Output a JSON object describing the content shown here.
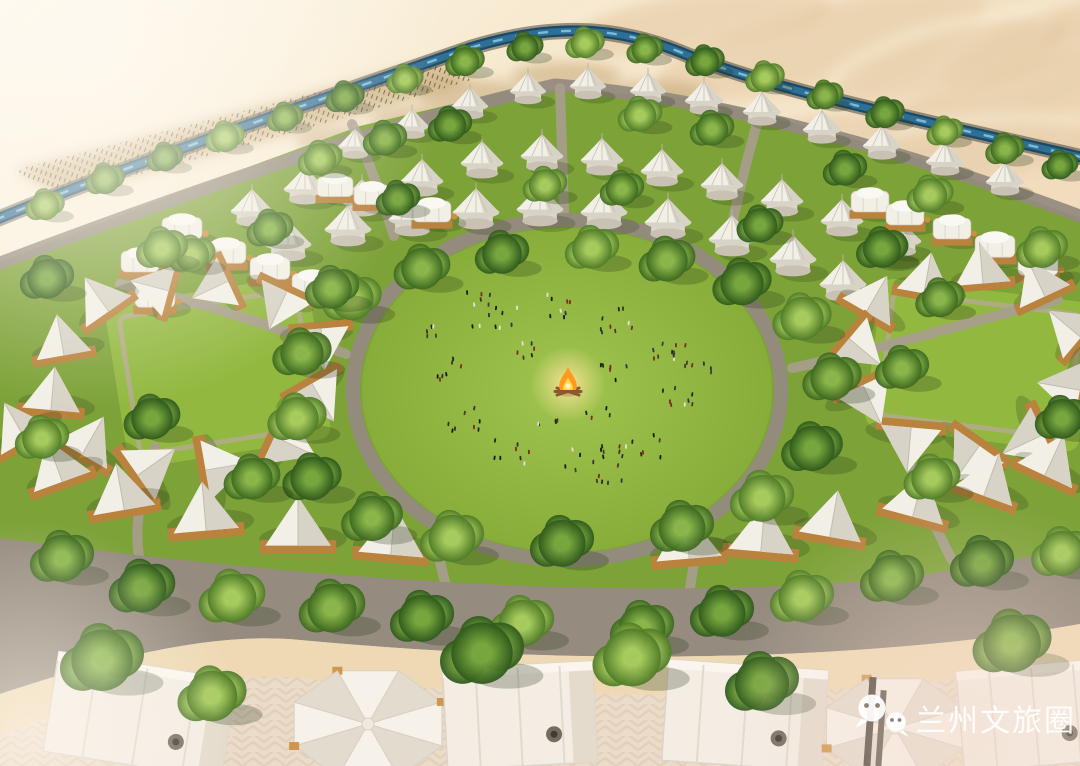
{
  "watermark": {
    "text": "兰州文旅圈",
    "logo": "wechat-icon",
    "color": "#ffffff"
  },
  "colors": {
    "sand_top": "#fdf9ee",
    "sand_mid": "#f4e4c8",
    "sand_warm": "#f1dcbd",
    "sand_pink": "#f1d9c5",
    "dune_shadow": "#dbb98c",
    "dune_light": "#f8ecd4",
    "reed_base": "#b08d52",
    "reed_dark": "#5f4722",
    "river_bank": "#3c3a30",
    "river_dark": "#1b4a66",
    "river_mid": "#2f6e95",
    "river_light": "#85c3de",
    "grass_base": "#7da238",
    "grass_bright": "#92b840",
    "grass_light": "#a3c84e",
    "road": "#958b7f",
    "road_light": "#a89d90",
    "path_light": "#b7a897",
    "sand_strip": "#eed9b4",
    "pavement": "#ebdcc9",
    "pavement_line": "#d8c3aa",
    "tent_white": "#f2efe7",
    "tent_shade": "#d8d3c7",
    "tent_dark": "#c2bcb0",
    "tent_orange": "#cc8f3f",
    "platform": "#b9823d",
    "tree_shadow": "#273618",
    "fire_glow": "#ffe49a",
    "fire_orange": "#ff9a1f",
    "fire_yellow": "#ffd84e",
    "people_dark": "#23261d"
  },
  "scene": {
    "river_path": "M -5 220 C 140 160 320 100 470 48 C 545 25 610 24 680 52 C 770 90 920 120 1085 158",
    "top_road_path": "M -5 265 C 180 195 380 125 555 85 C 720 98 910 152 1085 218",
    "camp_area": "M 0 262 L 180 192 L 360 126 L 520 88 L 700 98 L 900 152 L 1080 218 L 1080 560 L 900 588 L 700 616 L 500 636 L 300 612 L 100 572 L 0 548 Z",
    "bottom_road": "M 0 538 C 300 578 620 604 900 578 C 960 570 1030 556 1080 548 L 1080 624 C 900 656 620 670 300 640 C 200 630 80 668 0 694 Z",
    "sand_strip": "M 0 694 C 80 668 200 630 300 640 C 620 670 900 656 1080 624 L 1080 662 C 900 694 620 708 300 678 C 200 668 80 706 0 734 Z",
    "pavement": "M 0 734 C 80 706 200 668 300 678 C 620 708 900 694 1080 662 L 1080 766 L 0 766 Z",
    "central_lawn": {
      "cx": 567,
      "cy": 390,
      "rx": 205,
      "ry": 162
    },
    "left_lawn": {
      "cx": 218,
      "cy": 372,
      "w": 205,
      "h": 165,
      "rot": -9
    },
    "right_lawn": {
      "cx": 980,
      "cy": 365,
      "w": 215,
      "h": 150,
      "rot": 7
    },
    "campfire": {
      "x": 568,
      "y": 384
    },
    "reed_band": "M 15 170 Q 200 122 435 62 L 472 80 Q 265 142 58 196 Z",
    "reed_patches": [
      [
        478,
        96,
        60,
        16
      ],
      [
        566,
        76,
        55,
        14
      ],
      [
        652,
        96,
        60,
        15
      ],
      [
        420,
        120,
        50,
        14
      ],
      [
        340,
        140,
        45,
        13
      ]
    ],
    "dunes": [
      [
        820,
        45,
        170,
        48,
        -14
      ],
      [
        990,
        105,
        150,
        44,
        -18
      ],
      [
        700,
        22,
        130,
        36,
        -8
      ],
      [
        1045,
        45,
        110,
        38,
        -20
      ],
      [
        905,
        168,
        190,
        38,
        -10
      ],
      [
        760,
        150,
        140,
        30,
        -12
      ],
      [
        950,
        60,
        120,
        34,
        -16
      ]
    ],
    "connector_roads": [
      "M 352 124 C 372 168 384 204 394 236",
      "M 560 88 L 564 212",
      "M 758 120 C 746 162 736 204 728 244",
      "M 120 284 C 205 302 282 330 346 354",
      "M 1058 300 C 980 318 888 348 792 368",
      "M 438 554 L 450 602",
      "M 696 550 L 688 600",
      "M 155 447 C 141 492 131 532 142 570",
      "M 905 452 C 920 492 935 528 952 560"
    ],
    "yurts": [
      [
        355,
        152,
        0.8
      ],
      [
        412,
        132,
        0.8
      ],
      [
        470,
        112,
        0.85
      ],
      [
        528,
        97,
        0.85
      ],
      [
        588,
        92,
        0.85
      ],
      [
        648,
        97,
        0.85
      ],
      [
        704,
        107,
        0.9
      ],
      [
        762,
        118,
        0.9
      ],
      [
        822,
        136,
        0.9
      ],
      [
        882,
        152,
        0.9
      ],
      [
        945,
        168,
        0.9
      ],
      [
        1005,
        188,
        0.9
      ],
      [
        252,
        218,
        1.0
      ],
      [
        305,
        196,
        1.0
      ],
      [
        362,
        208,
        1.0
      ],
      [
        422,
        188,
        1.0
      ],
      [
        482,
        170,
        1.0
      ],
      [
        542,
        163,
        1.0
      ],
      [
        602,
        167,
        1.0
      ],
      [
        662,
        178,
        1.0
      ],
      [
        722,
        192,
        1.0
      ],
      [
        782,
        208,
        1.0
      ],
      [
        842,
        228,
        1.0
      ],
      [
        900,
        248,
        1.0
      ],
      [
        288,
        252,
        1.1
      ],
      [
        348,
        237,
        1.1
      ],
      [
        412,
        227,
        1.1
      ],
      [
        476,
        220,
        1.1
      ],
      [
        540,
        217,
        1.1
      ],
      [
        604,
        220,
        1.1
      ],
      [
        668,
        230,
        1.1
      ],
      [
        732,
        247,
        1.1
      ],
      [
        793,
        267,
        1.1
      ],
      [
        843,
        292,
        1.1
      ]
    ],
    "pillow_tents": [
      [
        182,
        232,
        1.0
      ],
      [
        226,
        256,
        1.0
      ],
      [
        270,
        272,
        1.0
      ],
      [
        312,
        288,
        1.0
      ],
      [
        335,
        190,
        0.9
      ],
      [
        372,
        198,
        0.9
      ],
      [
        432,
        215,
        0.95
      ],
      [
        870,
        205,
        0.95
      ],
      [
        905,
        218,
        0.95
      ],
      [
        952,
        232,
        0.95
      ],
      [
        995,
        250,
        1.0
      ],
      [
        1038,
        268,
        1.0
      ],
      [
        155,
        300,
        1.0
      ],
      [
        140,
        265,
        0.95
      ]
    ],
    "aframe_tents": [
      [
        102,
        302,
        1.1,
        -35
      ],
      [
        62,
        344,
        1.1,
        -10
      ],
      [
        52,
        398,
        1.15,
        5
      ],
      [
        88,
        444,
        1.15,
        30
      ],
      [
        148,
        468,
        1.2,
        55
      ],
      [
        218,
        468,
        1.2,
        80
      ],
      [
        286,
        442,
        1.2,
        115
      ],
      [
        318,
        394,
        1.15,
        150
      ],
      [
        322,
        340,
        1.1,
        175
      ],
      [
        282,
        302,
        1.1,
        -155
      ],
      [
        218,
        286,
        1.05,
        -115
      ],
      [
        158,
        288,
        1.05,
        -75
      ],
      [
        872,
        302,
        1.1,
        30
      ],
      [
        926,
        282,
        1.1,
        10
      ],
      [
        982,
        272,
        1.1,
        -5
      ],
      [
        1040,
        286,
        1.1,
        -25
      ],
      [
        1072,
        330,
        1.1,
        -50
      ],
      [
        1068,
        388,
        1.15,
        -80
      ],
      [
        1032,
        440,
        1.2,
        -115
      ],
      [
        972,
        456,
        1.2,
        -145
      ],
      [
        910,
        440,
        1.2,
        -175
      ],
      [
        868,
        396,
        1.15,
        155
      ],
      [
        858,
        346,
        1.1,
        130
      ]
    ],
    "bottom_tents": [
      [
        58,
        470,
        1.2,
        -20
      ],
      [
        122,
        497,
        1.25,
        -10
      ],
      [
        205,
        517,
        1.3,
        -5
      ],
      [
        298,
        532,
        1.3,
        0
      ],
      [
        392,
        541,
        1.3,
        5
      ],
      [
        688,
        545,
        1.3,
        -5
      ],
      [
        762,
        538,
        1.3,
        5
      ],
      [
        832,
        524,
        1.25,
        10
      ],
      [
        916,
        504,
        1.25,
        15
      ],
      [
        988,
        484,
        1.2,
        20
      ],
      [
        1050,
        464,
        1.2,
        25
      ],
      [
        20,
        430,
        1.15,
        -30
      ]
    ],
    "fg_tents": [
      {
        "type": "rect",
        "x": 140,
        "w": 180,
        "rot": 9
      },
      {
        "type": "hex",
        "x": 368,
        "y": 724,
        "r": 80
      },
      {
        "type": "rect",
        "x": 520,
        "w": 150,
        "rot": -3
      },
      {
        "type": "rect",
        "x": 745,
        "w": 160,
        "rot": 4
      },
      {
        "type": "hex",
        "x": 895,
        "y": 728,
        "r": 74
      },
      {
        "type": "rect",
        "x": 1035,
        "w": 150,
        "rot": -5
      }
    ],
    "trees": [
      [
        45,
        208,
        0.8
      ],
      [
        105,
        182,
        0.8
      ],
      [
        165,
        160,
        0.75
      ],
      [
        225,
        140,
        0.8
      ],
      [
        285,
        120,
        0.75
      ],
      [
        345,
        100,
        0.8
      ],
      [
        405,
        82,
        0.75
      ],
      [
        465,
        64,
        0.8
      ],
      [
        525,
        50,
        0.75
      ],
      [
        585,
        46,
        0.8
      ],
      [
        645,
        52,
        0.75
      ],
      [
        705,
        64,
        0.8
      ],
      [
        765,
        80,
        0.8
      ],
      [
        825,
        98,
        0.75
      ],
      [
        885,
        116,
        0.8
      ],
      [
        945,
        134,
        0.75
      ],
      [
        1005,
        152,
        0.8
      ],
      [
        1060,
        168,
        0.75
      ],
      [
        320,
        162,
        0.9
      ],
      [
        385,
        142,
        0.9
      ],
      [
        450,
        128,
        0.9
      ],
      [
        640,
        118,
        0.9
      ],
      [
        712,
        132,
        0.9
      ],
      [
        845,
        172,
        0.9
      ],
      [
        930,
        198,
        0.95
      ],
      [
        270,
        232,
        0.95
      ],
      [
        398,
        202,
        0.9
      ],
      [
        545,
        188,
        0.9
      ],
      [
        622,
        192,
        0.9
      ],
      [
        760,
        228,
        0.95
      ],
      [
        192,
        258,
        0.95
      ],
      [
        940,
        302,
        1.0
      ],
      [
        885,
        252,
        0.95
      ],
      [
        352,
        302,
        1.2
      ],
      [
        422,
        272,
        1.15
      ],
      [
        502,
        257,
        1.1
      ],
      [
        592,
        252,
        1.1
      ],
      [
        667,
        264,
        1.15
      ],
      [
        742,
        287,
        1.2
      ],
      [
        802,
        322,
        1.2
      ],
      [
        832,
        382,
        1.2
      ],
      [
        812,
        452,
        1.25
      ],
      [
        762,
        502,
        1.3
      ],
      [
        682,
        532,
        1.3
      ],
      [
        562,
        547,
        1.3
      ],
      [
        452,
        542,
        1.3
      ],
      [
        372,
        522,
        1.25
      ],
      [
        312,
        482,
        1.2
      ],
      [
        297,
        422,
        1.2
      ],
      [
        302,
        357,
        1.2
      ],
      [
        47,
        282,
        1.1
      ],
      [
        162,
        252,
        1.05
      ],
      [
        332,
        292,
        1.1
      ],
      [
        152,
        422,
        1.15
      ],
      [
        42,
        442,
        1.1
      ],
      [
        252,
        482,
        1.15
      ],
      [
        882,
        252,
        1.05
      ],
      [
        1042,
        252,
        1.05
      ],
      [
        902,
        372,
        1.1
      ],
      [
        1062,
        422,
        1.1
      ],
      [
        932,
        482,
        1.15
      ],
      [
        62,
        562,
        1.3
      ],
      [
        142,
        592,
        1.35
      ],
      [
        232,
        602,
        1.35
      ],
      [
        332,
        612,
        1.35
      ],
      [
        422,
        622,
        1.3
      ],
      [
        522,
        627,
        1.3
      ],
      [
        642,
        632,
        1.3
      ],
      [
        722,
        617,
        1.3
      ],
      [
        802,
        602,
        1.3
      ],
      [
        892,
        582,
        1.3
      ],
      [
        982,
        567,
        1.3
      ],
      [
        1062,
        557,
        1.25
      ],
      [
        102,
        665,
        1.7
      ],
      [
        482,
        658,
        1.7
      ],
      [
        632,
        662,
        1.6
      ],
      [
        1012,
        648,
        1.6
      ],
      [
        762,
        688,
        1.5
      ],
      [
        212,
        700,
        1.4
      ]
    ],
    "people_clusters": [
      [
        498,
        322,
        10,
        26
      ],
      [
        562,
        306,
        8,
        22
      ],
      [
        625,
        320,
        9,
        24
      ],
      [
        664,
        356,
        10,
        22
      ],
      [
        676,
        402,
        8,
        20
      ],
      [
        640,
        446,
        10,
        24
      ],
      [
        580,
        462,
        9,
        24
      ],
      [
        513,
        454,
        8,
        22
      ],
      [
        468,
        420,
        8,
        20
      ],
      [
        455,
        370,
        7,
        18
      ],
      [
        522,
        352,
        6,
        16
      ],
      [
        612,
        372,
        6,
        16
      ],
      [
        432,
        332,
        5,
        16
      ],
      [
        700,
        372,
        6,
        16
      ],
      [
        610,
        478,
        6,
        18
      ],
      [
        480,
        300,
        5,
        14
      ],
      [
        545,
        420,
        5,
        14
      ],
      [
        598,
        416,
        4,
        12
      ]
    ]
  }
}
